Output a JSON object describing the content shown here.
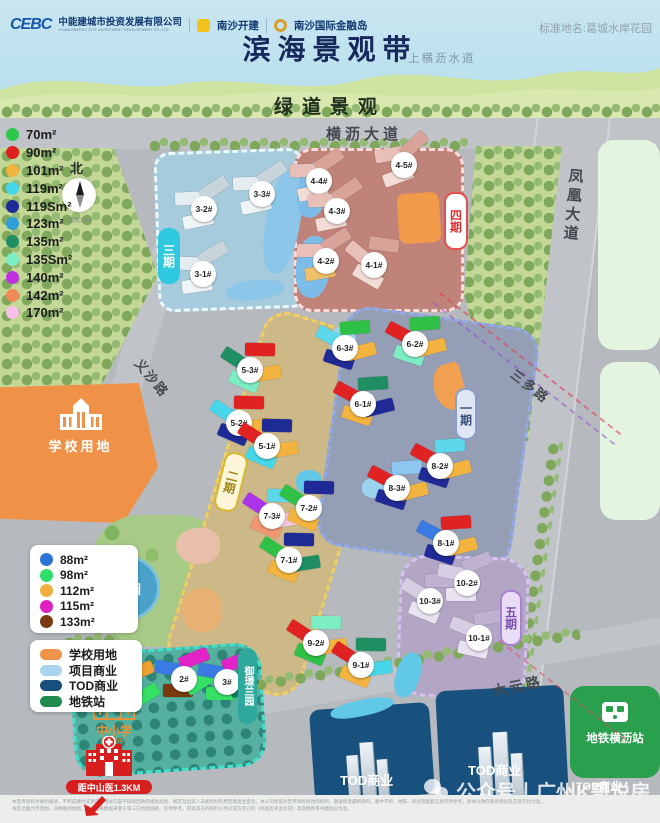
{
  "header": {
    "logo1_mark": "CEBC",
    "logo1_name": "中能建城市投资发展有限公司",
    "logo1_sub": "CHINA ENERGY CITY INVESTMENT DEVELOPMENT CO.,LTD",
    "logo2_name": "南沙开建",
    "logo3_name": "南沙国际金融岛",
    "standard_name": "标准地名:葛城水岸花园",
    "title": "滨海景观带",
    "waterway": "上横沥水道",
    "greenway": "绿道景观"
  },
  "compass": {
    "label": "北",
    "caption": "指北方向"
  },
  "roads": {
    "hengli": "横沥大道",
    "fenghuang": "凤凰大道",
    "sanduo": "三多路",
    "yisha": "义沙路",
    "dayuan": "大元路"
  },
  "areas": {
    "phase1": "一期",
    "phase2": "二期",
    "phase3": "三期",
    "phase4": "四期",
    "phase5": "五期",
    "estate": "御璟兰园",
    "park": "公园",
    "school_land": "学校用地",
    "school_note": "中小学",
    "school_note_sub": "(规划中)",
    "hospital_note": "距中山医1.3KM",
    "tod_a": "TOD商业",
    "tod_b": "TOD商业",
    "tod_c": "TOD商业",
    "metro": "地铁横沥站"
  },
  "legend_new_units": {
    "items": [
      {
        "label": "70m²",
        "color": "#2ec84e"
      },
      {
        "label": "90m²",
        "color": "#e02020"
      },
      {
        "label": "101m²",
        "color": "#f0b43c"
      },
      {
        "label": "119m²",
        "color": "#46d8ea"
      },
      {
        "label": "119Sm²",
        "color": "#1f2a96"
      },
      {
        "label": "123m²",
        "color": "#2d9fd6"
      },
      {
        "label": "135m²",
        "color": "#1f8f63"
      },
      {
        "label": "135Sm²",
        "color": "#7deec4"
      },
      {
        "label": "140m²",
        "color": "#c030e0"
      },
      {
        "label": "142m²",
        "color": "#f08858"
      },
      {
        "label": "170m²",
        "color": "#f8c0e8"
      }
    ]
  },
  "legend_estate_units": {
    "items": [
      {
        "label": "88m²",
        "color": "#2a74d8"
      },
      {
        "label": "98m²",
        "color": "#2ee06a"
      },
      {
        "label": "112m²",
        "color": "#f0b040"
      },
      {
        "label": "115m²",
        "color": "#e020c0"
      },
      {
        "label": "133m²",
        "color": "#7a3a10"
      }
    ]
  },
  "legend_areas": {
    "items": [
      {
        "label": "学校用地",
        "color": "#f0924a"
      },
      {
        "label": "项目商业",
        "color": "#a8d4ec"
      },
      {
        "label": "TOD商业",
        "color": "#17507d"
      },
      {
        "label": "地铁站",
        "color": "#1f8a4d"
      }
    ]
  },
  "buildings": [
    {
      "label": "3-3#",
      "x": 262,
      "y": 196,
      "rot": -20,
      "blocks": [
        "#e6edf2",
        "#c7d4dc",
        "#f0f5f8"
      ]
    },
    {
      "label": "3-2#",
      "x": 204,
      "y": 211,
      "rot": -20,
      "blocks": [
        "#e6edf2",
        "#c7d4dc",
        "#f0f5f8"
      ]
    },
    {
      "label": "3-1#",
      "x": 203,
      "y": 276,
      "rot": -16,
      "blocks": [
        "#e6edf2",
        "#c7d4dc",
        "#f0f5f8"
      ]
    },
    {
      "label": "4-5#",
      "x": 404,
      "y": 167,
      "rot": -28,
      "blocks": [
        "#e9c0b8",
        "#d8a49a",
        "#f3dcd6"
      ]
    },
    {
      "label": "4-4#",
      "x": 319,
      "y": 183,
      "rot": -20,
      "blocks": [
        "#e9c0b8",
        "#d8a49a",
        "#f3dcd6"
      ]
    },
    {
      "label": "4-3#",
      "x": 337,
      "y": 213,
      "rot": -20,
      "blocks": [
        "#e9c0b8",
        "#d8a49a",
        "#f3dcd6"
      ]
    },
    {
      "label": "4-2#",
      "x": 326,
      "y": 263,
      "rot": -18,
      "blocks": [
        "#e9c0b8",
        "#d8a49a",
        "#f0c068"
      ]
    },
    {
      "label": "4-1#",
      "x": 374,
      "y": 267,
      "rot": 22,
      "blocks": [
        "#e9c0b8",
        "#d8a49a",
        "#f3dcd6"
      ]
    },
    {
      "label": "5-3#",
      "x": 250,
      "y": 372,
      "rot": 15,
      "blocks": [
        "#1f8f63",
        "#e02222",
        "#7deec4",
        "#f2b43e"
      ]
    },
    {
      "label": "5-2#",
      "x": 239,
      "y": 425,
      "rot": 15,
      "blocks": [
        "#46d8ea",
        "#e02222",
        "#1f2a96",
        "#f2b43e"
      ]
    },
    {
      "label": "5-1#",
      "x": 267,
      "y": 448,
      "rot": 15,
      "blocks": [
        "#e02222",
        "#1f2a96",
        "#46d8ea",
        "#f2b43e"
      ]
    },
    {
      "label": "7-3#",
      "x": 272,
      "y": 518,
      "rot": 15,
      "blocks": [
        "#ab34e8",
        "#5cd8ea",
        "#f29672",
        "#f6c6da"
      ]
    },
    {
      "label": "7-2#",
      "x": 309,
      "y": 510,
      "rot": 15,
      "blocks": [
        "#2fc145",
        "#1f2a96",
        "#f2b43e"
      ]
    },
    {
      "label": "7-1#",
      "x": 289,
      "y": 562,
      "rot": 15,
      "blocks": [
        "#2fc145",
        "#1f2a96",
        "#f2b43e",
        "#1f8f63"
      ]
    },
    {
      "label": "9-2#",
      "x": 316,
      "y": 645,
      "rot": 15,
      "blocks": [
        "#e02222",
        "#7deec4",
        "#2fc145",
        "#f2b43e"
      ]
    },
    {
      "label": "9-1#",
      "x": 361,
      "y": 667,
      "rot": 15,
      "blocks": [
        "#e02222",
        "#1f8f63",
        "#f2b43e",
        "#46d8ea"
      ]
    },
    {
      "label": "6-3#",
      "x": 345,
      "y": 350,
      "rot": 10,
      "blocks": [
        "#5cd8ea",
        "#2fc145",
        "#1f2a96",
        "#f2b43e"
      ]
    },
    {
      "label": "6-2#",
      "x": 415,
      "y": 346,
      "rot": 10,
      "blocks": [
        "#e02222",
        "#2fc145",
        "#7deec4",
        "#f2b43e"
      ]
    },
    {
      "label": "6-1#",
      "x": 363,
      "y": 406,
      "rot": 10,
      "blocks": [
        "#e02222",
        "#1f8f63",
        "#f2b43e",
        "#1f2a96"
      ]
    },
    {
      "label": "8-3#",
      "x": 397,
      "y": 490,
      "rot": 10,
      "blocks": [
        "#e02222",
        "#8ec8f2",
        "#1f2a96",
        "#f2b43e"
      ]
    },
    {
      "label": "8-2#",
      "x": 440,
      "y": 468,
      "rot": 10,
      "blocks": [
        "#e02222",
        "#5cd8ea",
        "#1f2a96",
        "#f2b43e"
      ]
    },
    {
      "label": "8-1#",
      "x": 446,
      "y": 545,
      "rot": 10,
      "blocks": [
        "#3a7ae2",
        "#e02222",
        "#1f2a96",
        "#f2b43e"
      ]
    },
    {
      "label": "10-3#",
      "x": 430,
      "y": 603,
      "rot": 14,
      "blocks": [
        "#d6cee2",
        "#beb2d0",
        "#e9e3f1"
      ]
    },
    {
      "label": "10-2#",
      "x": 467,
      "y": 585,
      "rot": -8,
      "blocks": [
        "#d6cee2",
        "#beb2d0",
        "#e9e3f1"
      ]
    },
    {
      "label": "10-1#",
      "x": 479,
      "y": 640,
      "rot": 4,
      "blocks": [
        "#d6cee2",
        "#beb2d0",
        "#e9e3f1"
      ]
    },
    {
      "label": "1#",
      "x": 129,
      "y": 694,
      "rot": -8,
      "blocks": [
        "#0f7a66",
        "#f0a030",
        "#e322c8",
        "#35e065"
      ]
    },
    {
      "label": "2#",
      "x": 184,
      "y": 681,
      "rot": -8,
      "blocks": [
        "#3a7ae2",
        "#e322c8",
        "#7a3a10",
        "#35e065"
      ]
    },
    {
      "label": "3#",
      "x": 227,
      "y": 684,
      "rot": -8,
      "blocks": [
        "#3a7ae2",
        "#e322c8",
        "#35e065",
        "#0f7a66"
      ]
    }
  ],
  "watermark": "公众号丨广州K哥说房",
  "disclaimer_1": "本宣传资料为要约邀请，不构成要约或承诺，相关内容不排除因政府相关规划、规定及出卖人未能控制的原因而发生变化，本公司保留对宣传资料修改的权利，敬请留意最新资料。图中学校、地铁、商业等配套信息仅供参考，具体以政府最终规划及实际交付为准。",
  "disclaimer_2": "本区位图为示意图，非精确测绘图，相关距离数据来源于第三方地图测距，仅供参考。买卖双方的权利义务以双方签订的《商品房买卖合同》及其附件等书面协议为准。"
}
